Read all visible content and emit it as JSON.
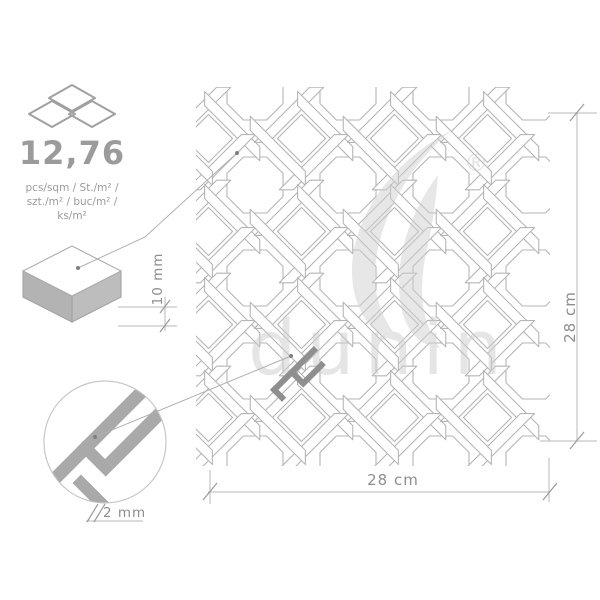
{
  "product": {
    "density_value": "12,76",
    "density_units": [
      "pcs/sqm / St./m² /",
      "szt./m² / buc/m² /",
      "ks/m²"
    ]
  },
  "dimensions": {
    "width_label": "28  cm",
    "height_label": "28 cm",
    "thickness_label": "10 mm",
    "joint_label": "2 mm"
  },
  "watermark": {
    "brand": "dunin",
    "registered": "®"
  },
  "colors": {
    "tile_line": "#b5b5b5",
    "text_gray": "#9b9b9b",
    "dim_line": "#b9b9b9",
    "tick": "#9b9b9b",
    "leader": "#b0b0b0",
    "dot": "#7f7f7f",
    "watermark_gray": "#d0d0d0",
    "grout_highlight": "#8f8f8f",
    "detail_band": "#a9a9a9",
    "detail_ring": "#c6c6c6",
    "box_left": "#b3b3b3",
    "box_right": "#bdbdbd"
  }
}
